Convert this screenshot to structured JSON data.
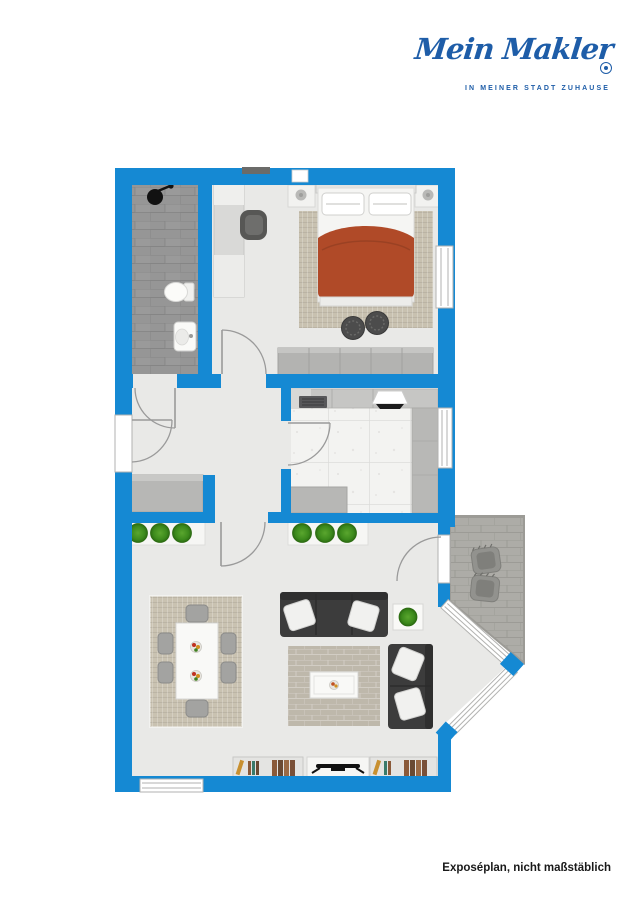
{
  "logo": {
    "brand": "Mein Makler",
    "tagline": "IN MEINER STADT ZUHAUSE"
  },
  "footer": {
    "caption": "Exposéplan, nicht maßstäblich"
  },
  "colors": {
    "wall": "#1589d3",
    "floor": "#e9e9e7",
    "bathroom_floor": "#969696",
    "bathroom_grout": "#858585",
    "kitchen_tile": "#f3f3f1",
    "kitchen_grout": "#dcdcda",
    "counter": "#c6c6c4",
    "counter_dark": "#b8b8b6",
    "stove": "#58585a",
    "cabinet": "#b7b7b5",
    "wardrobe": "#b3b3b1",
    "rug_dining": "#c9c2b1",
    "rug_living": "#beb8ab",
    "rug_bed": "#c8c1b0",
    "sofa": "#3c3c3c",
    "blanket": "#b04a28",
    "plant": "#3c8a1c",
    "pouf": "#4c4c4c",
    "balcony_tile": "#adaca7",
    "balcony_grout": "#9c9b96",
    "door_line": "#9a9a9a",
    "tv": "#111111",
    "logo_blue": "#1e5da8",
    "footer_text": "#191919"
  },
  "plan": {
    "rooms": [
      {
        "id": "bathroom",
        "furniture": [
          "shower",
          "toilet",
          "sink"
        ]
      },
      {
        "id": "bedroom",
        "furniture": [
          "double-bed",
          "nightstand-left",
          "nightstand-right",
          "desk",
          "desk-chair",
          "wardrobe",
          "pouf",
          "pouf",
          "rug"
        ]
      },
      {
        "id": "hallway",
        "furniture": [
          "sideboard"
        ]
      },
      {
        "id": "kitchen",
        "furniture": [
          "counter",
          "stove",
          "hood",
          "side-counter",
          "low-cabinet"
        ]
      },
      {
        "id": "living-dining-room",
        "furniture": [
          "plant-shelf",
          "plant-shelf",
          "dining-table",
          "dining-chairs",
          "sofa-large",
          "sofa-small",
          "side-table",
          "coffee-table",
          "rug",
          "bookshelf",
          "tv-board",
          "bookshelf"
        ]
      },
      {
        "id": "balcony",
        "furniture": [
          "outdoor-chair",
          "outdoor-chair"
        ]
      }
    ]
  }
}
